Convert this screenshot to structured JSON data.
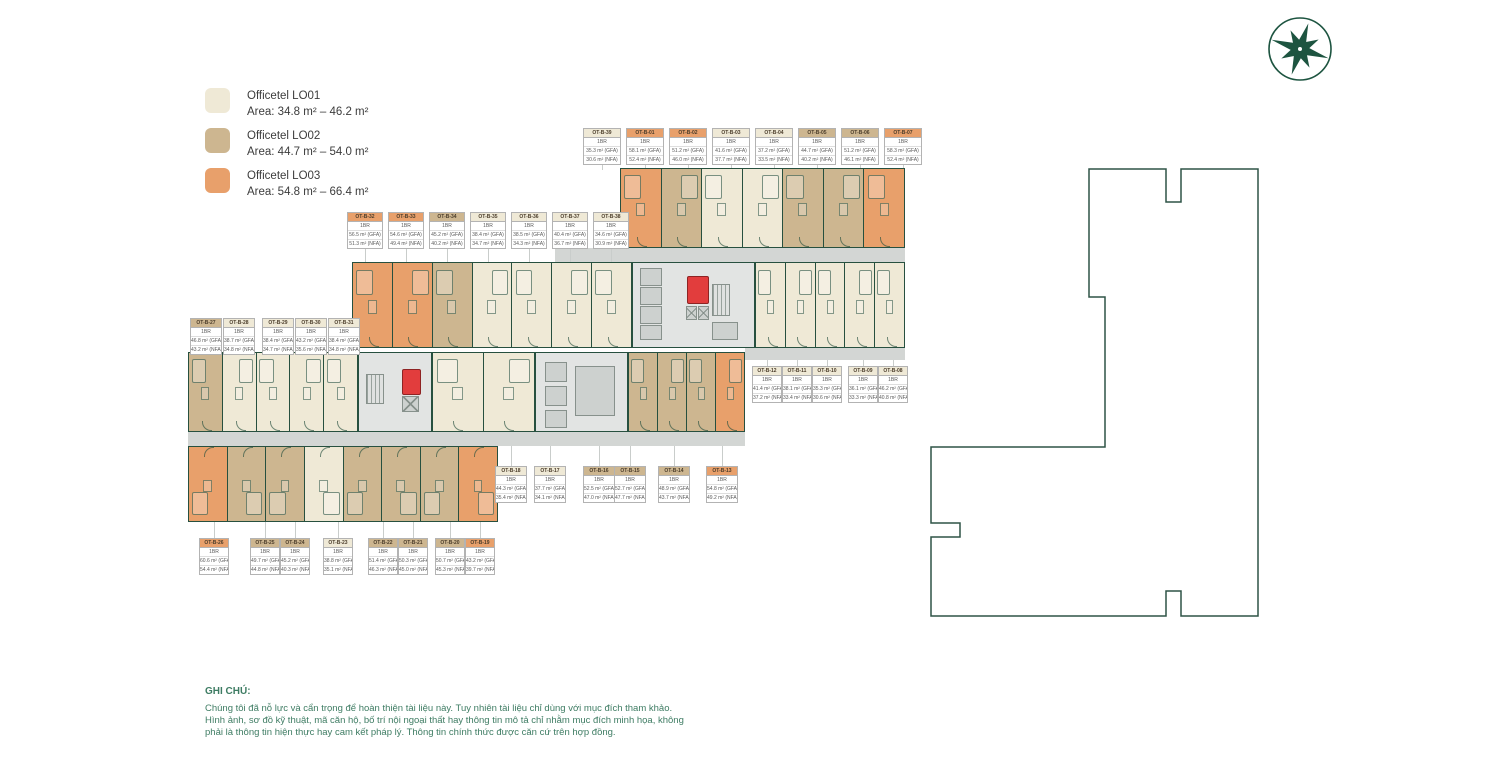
{
  "legend": {
    "items": [
      {
        "label": "Officetel LO01",
        "area": "Area: 34.8 m² – 46.2 m²",
        "color": "#efe9d6"
      },
      {
        "label": "Officetel LO02",
        "area": "Area: 44.7 m² – 54.0 m²",
        "color": "#cdb690"
      },
      {
        "label": "Officetel LO03",
        "area": "Area: 54.8 m² – 66.4 m²",
        "color": "#e8a06b"
      }
    ]
  },
  "colors": {
    "LO01": "#efe9d6",
    "LO02": "#cdb690",
    "LO03": "#e8a06b",
    "wall": "#27503f",
    "corridor": "#d3d6d4",
    "elevator_red": "#e23d3d",
    "note_green": "#3e7c63",
    "logo_green": "#1d5440"
  },
  "note": {
    "title": "GHI CHÚ:",
    "lines": [
      "Chúng tôi đã nỗ lực và cẩn trọng để hoàn thiện tài liệu này. Tuy nhiên tài liệu chỉ dùng với mục đích tham khảo.",
      "Hình ảnh, sơ đồ kỹ thuật, mã căn hộ, bố trí nội ngoại thất hay thông tin mô tả chỉ nhằm mục đích minh họa, không",
      "phải là thông tin hiện thực hay cam kết pháp lý. Thông tin chính thức được căn cứ trên hợp đồng."
    ]
  },
  "unit_labels": {
    "row1": [
      {
        "code": "OT-B-39",
        "type": "LO01",
        "br": "1BR",
        "gfa": "35.3 m² (GFA)",
        "nfa": "30.6 m² (NFA)"
      },
      {
        "code": "OT-B-01",
        "type": "LO03",
        "br": "1BR",
        "gfa": "58.1 m² (GFA)",
        "nfa": "52.4 m² (NFA)"
      },
      {
        "code": "OT-B-02",
        "type": "LO03",
        "br": "1BR",
        "gfa": "51.2 m² (GFA)",
        "nfa": "46.0 m² (NFA)"
      },
      {
        "code": "OT-B-03",
        "type": "LO01",
        "br": "1BR",
        "gfa": "41.6 m² (GFA)",
        "nfa": "37.7 m² (NFA)"
      },
      {
        "code": "OT-B-04",
        "type": "LO01",
        "br": "1BR",
        "gfa": "37.2 m² (GFA)",
        "nfa": "33.5 m² (NFA)"
      },
      {
        "code": "OT-B-05",
        "type": "LO02",
        "br": "1BR",
        "gfa": "44.7 m² (GFA)",
        "nfa": "40.2 m² (NFA)"
      },
      {
        "code": "OT-B-06",
        "type": "LO02",
        "br": "1BR",
        "gfa": "51.2 m² (GFA)",
        "nfa": "46.1 m² (NFA)"
      },
      {
        "code": "OT-B-07",
        "type": "LO03",
        "br": "1BR",
        "gfa": "58.3 m² (GFA)",
        "nfa": "52.4 m² (NFA)"
      }
    ],
    "row2": [
      {
        "code": "OT-B-32",
        "type": "LO03",
        "br": "1BR",
        "gfa": "56.5 m² (GFA)",
        "nfa": "51.3 m² (NFA)"
      },
      {
        "code": "OT-B-33",
        "type": "LO03",
        "br": "1BR",
        "gfa": "54.6 m² (GFA)",
        "nfa": "49.4 m² (NFA)"
      },
      {
        "code": "OT-B-34",
        "type": "LO02",
        "br": "1BR",
        "gfa": "45.2 m² (GFA)",
        "nfa": "40.2 m² (NFA)"
      },
      {
        "code": "OT-B-35",
        "type": "LO01",
        "br": "1BR",
        "gfa": "38.4 m² (GFA)",
        "nfa": "34.7 m² (NFA)"
      },
      {
        "code": "OT-B-36",
        "type": "LO01",
        "br": "1BR",
        "gfa": "38.5 m² (GFA)",
        "nfa": "34.3 m² (NFA)"
      },
      {
        "code": "OT-B-37",
        "type": "LO01",
        "br": "1BR",
        "gfa": "40.4 m² (GFA)",
        "nfa": "36.7 m² (NFA)"
      },
      {
        "code": "OT-B-38",
        "type": "LO01",
        "br": "1BR",
        "gfa": "34.6 m² (GFA)",
        "nfa": "30.9 m² (NFA)"
      }
    ],
    "row3": [
      {
        "code": "OT-B-27",
        "type": "LO02",
        "br": "1BR",
        "gfa": "46.8 m² (GFA)",
        "nfa": "43.2 m² (NFA)"
      },
      {
        "code": "OT-B-28",
        "type": "LO01",
        "br": "1BR",
        "gfa": "38.7 m² (GFA)",
        "nfa": "34.8 m² (NFA)"
      },
      {
        "code": "OT-B-29",
        "type": "LO01",
        "br": "1BR",
        "gfa": "38.4 m² (GFA)",
        "nfa": "34.7 m² (NFA)"
      },
      {
        "code": "OT-B-30",
        "type": "LO01",
        "br": "1BR",
        "gfa": "43.2 m² (GFA)",
        "nfa": "35.6 m² (NFA)"
      },
      {
        "code": "OT-B-31",
        "type": "LO01",
        "br": "1BR",
        "gfa": "38.4 m² (GFA)",
        "nfa": "34.8 m² (NFA)"
      }
    ],
    "row4": [
      {
        "code": "OT-B-12",
        "type": "LO01",
        "br": "1BR",
        "gfa": "41.4 m² (GFA)",
        "nfa": "37.2 m² (NFA)"
      },
      {
        "code": "OT-B-11",
        "type": "LO01",
        "br": "1BR",
        "gfa": "38.1 m² (GFA)",
        "nfa": "33.4 m² (NFA)"
      },
      {
        "code": "OT-B-10",
        "type": "LO01",
        "br": "1BR",
        "gfa": "35.3 m² (GFA)",
        "nfa": "30.6 m² (NFA)"
      },
      {
        "code": "OT-B-09",
        "type": "LO01",
        "br": "1BR",
        "gfa": "36.1 m² (GFA)",
        "nfa": "33.3 m² (NFA)"
      },
      {
        "code": "OT-B-08",
        "type": "LO01",
        "br": "1BR",
        "gfa": "46.2 m² (GFA)",
        "nfa": "40.8 m² (NFA)"
      }
    ],
    "row5": [
      {
        "code": "OT-B-18",
        "type": "LO01",
        "br": "1BR",
        "gfa": "44.3 m² (GFA)",
        "nfa": "35.4 m² (NFA)"
      },
      {
        "code": "OT-B-17",
        "type": "LO01",
        "br": "1BR",
        "gfa": "37.7 m² (GFA)",
        "nfa": "34.1 m² (NFA)"
      },
      {
        "code": "OT-B-16",
        "type": "LO02",
        "br": "1BR",
        "gfa": "52.5 m² (GFA)",
        "nfa": "47.0 m² (NFA)"
      },
      {
        "code": "OT-B-15",
        "type": "LO02",
        "br": "1BR",
        "gfa": "52.7 m² (GFA)",
        "nfa": "47.7 m² (NFA)"
      },
      {
        "code": "OT-B-14",
        "type": "LO02",
        "br": "1BR",
        "gfa": "48.9 m² (GFA)",
        "nfa": "43.7 m² (NFA)"
      },
      {
        "code": "OT-B-13",
        "type": "LO03",
        "br": "1BR",
        "gfa": "54.8 m² (GFA)",
        "nfa": "49.2 m² (NFA)"
      }
    ],
    "row6": [
      {
        "code": "OT-B-26",
        "type": "LO03",
        "br": "1BR",
        "gfa": "60.6 m² (GFA)",
        "nfa": "54.4 m² (NFA)"
      },
      {
        "code": "OT-B-25",
        "type": "LO02",
        "br": "1BR",
        "gfa": "49.7 m² (GFA)",
        "nfa": "44.8 m² (NFA)"
      },
      {
        "code": "OT-B-24",
        "type": "LO02",
        "br": "1BR",
        "gfa": "45.2 m² (GFA)",
        "nfa": "40.3 m² (NFA)"
      },
      {
        "code": "OT-B-23",
        "type": "LO01",
        "br": "1BR",
        "gfa": "38.8 m² (GFA)",
        "nfa": "35.1 m² (NFA)"
      },
      {
        "code": "OT-B-22",
        "type": "LO02",
        "br": "1BR",
        "gfa": "51.4 m² (GFA)",
        "nfa": "46.3 m² (NFA)"
      },
      {
        "code": "OT-B-21",
        "type": "LO02",
        "br": "1BR",
        "gfa": "50.3 m² (GFA)",
        "nfa": "45.0 m² (NFA)"
      },
      {
        "code": "OT-B-20",
        "type": "LO02",
        "br": "1BR",
        "gfa": "50.7 m² (GFA)",
        "nfa": "45.3 m² (NFA)"
      },
      {
        "code": "OT-B-19",
        "type": "LO03",
        "br": "1BR",
        "gfa": "43.2 m² (GFA)",
        "nfa": "39.7 m² (NFA)"
      }
    ]
  },
  "plan": {
    "blocks": {
      "top": [
        "LO03",
        "LO02",
        "LO01",
        "LO01",
        "LO02",
        "LO02",
        "LO03"
      ],
      "second": [
        "LO03",
        "LO03",
        "LO02",
        "LO01",
        "LO01",
        "LO01",
        "LO01"
      ],
      "rightMid": [
        "LO01",
        "LO01",
        "LO01",
        "LO01",
        "LO01"
      ],
      "midLeft": [
        "LO02",
        "LO01",
        "LO01",
        "LO01",
        "LO01"
      ],
      "midCenter": [
        "LO01",
        "LO01"
      ],
      "midRight": [
        "LO02",
        "LO02",
        "LO02",
        "LO03"
      ],
      "bottom": [
        "LO03",
        "LO02",
        "LO02",
        "LO01",
        "LO02",
        "LO02",
        "LO02",
        "LO03"
      ]
    }
  }
}
